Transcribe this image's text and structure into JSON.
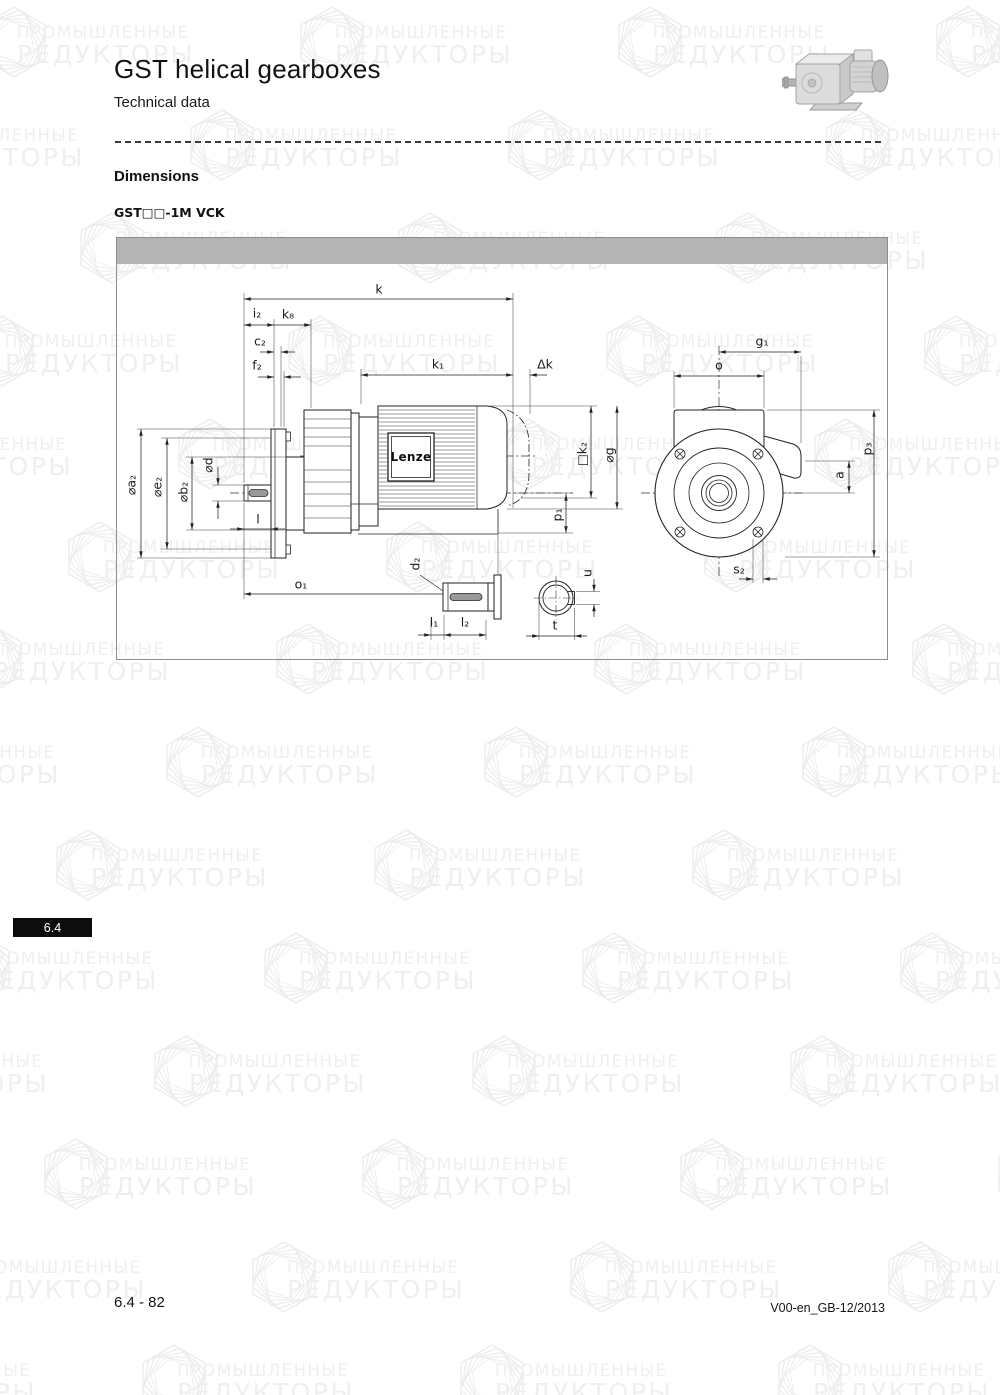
{
  "page": {
    "title": "GST helical gearboxes",
    "subtitle": "Technical data",
    "section_heading": "Dimensions",
    "model_label": "GST□□-1M VCK",
    "section_tab": "6.4",
    "footer_left": "6.4 - 82",
    "footer_right": "V00-en_GB-12/2013"
  },
  "watermark": {
    "line1": "ПРОМЫШЛЕННЫЕ",
    "line2": "РЕДУКТОРЫ"
  },
  "drawing": {
    "brand_label": "Lenze",
    "labels": [
      {
        "t": "k",
        "x": 262,
        "y": 51
      },
      {
        "t": "i₂",
        "x": 140,
        "y": 75
      },
      {
        "t": "k₈",
        "x": 171,
        "y": 76
      },
      {
        "t": "c₂",
        "x": 143,
        "y": 103
      },
      {
        "t": "f₂",
        "x": 140,
        "y": 127
      },
      {
        "t": "k₁",
        "x": 321,
        "y": 126
      },
      {
        "t": "Δk",
        "x": 428,
        "y": 126
      },
      {
        "t": "⌀a₂",
        "x": 14,
        "y": 247,
        "r": 1
      },
      {
        "t": "⌀e₂",
        "x": 40,
        "y": 249,
        "r": 1
      },
      {
        "t": "⌀b₂",
        "x": 66,
        "y": 254,
        "r": 1
      },
      {
        "t": "⌀d",
        "x": 91,
        "y": 227,
        "r": 1
      },
      {
        "t": "l",
        "x": 141,
        "y": 281
      },
      {
        "t": "o₁",
        "x": 184,
        "y": 346
      },
      {
        "t": "□k₂",
        "x": 465,
        "y": 216,
        "r": 1
      },
      {
        "t": "⌀g",
        "x": 492,
        "y": 217,
        "r": 1
      },
      {
        "t": "p₁",
        "x": 440,
        "y": 277,
        "r": 1
      },
      {
        "t": "g₁",
        "x": 645,
        "y": 103
      },
      {
        "t": "o",
        "x": 602,
        "y": 127
      },
      {
        "t": "p₃",
        "x": 750,
        "y": 211,
        "r": 1
      },
      {
        "t": "a",
        "x": 722,
        "y": 237,
        "r": 1
      },
      {
        "t": "s₂",
        "x": 622,
        "y": 331
      },
      {
        "t": "d₂",
        "x": 298,
        "y": 326,
        "r": 1
      },
      {
        "t": "l₁",
        "x": 317,
        "y": 384
      },
      {
        "t": "l₂",
        "x": 348,
        "y": 384
      },
      {
        "t": "u",
        "x": 470,
        "y": 335,
        "r": 1
      },
      {
        "t": "t",
        "x": 438,
        "y": 387
      }
    ]
  },
  "colors": {
    "drawing_bar": "#b4b4b4",
    "badge_bg": "#0d0d0d",
    "badge_text": "#ffffff",
    "watermark": "#efefef",
    "line": "#222222"
  }
}
